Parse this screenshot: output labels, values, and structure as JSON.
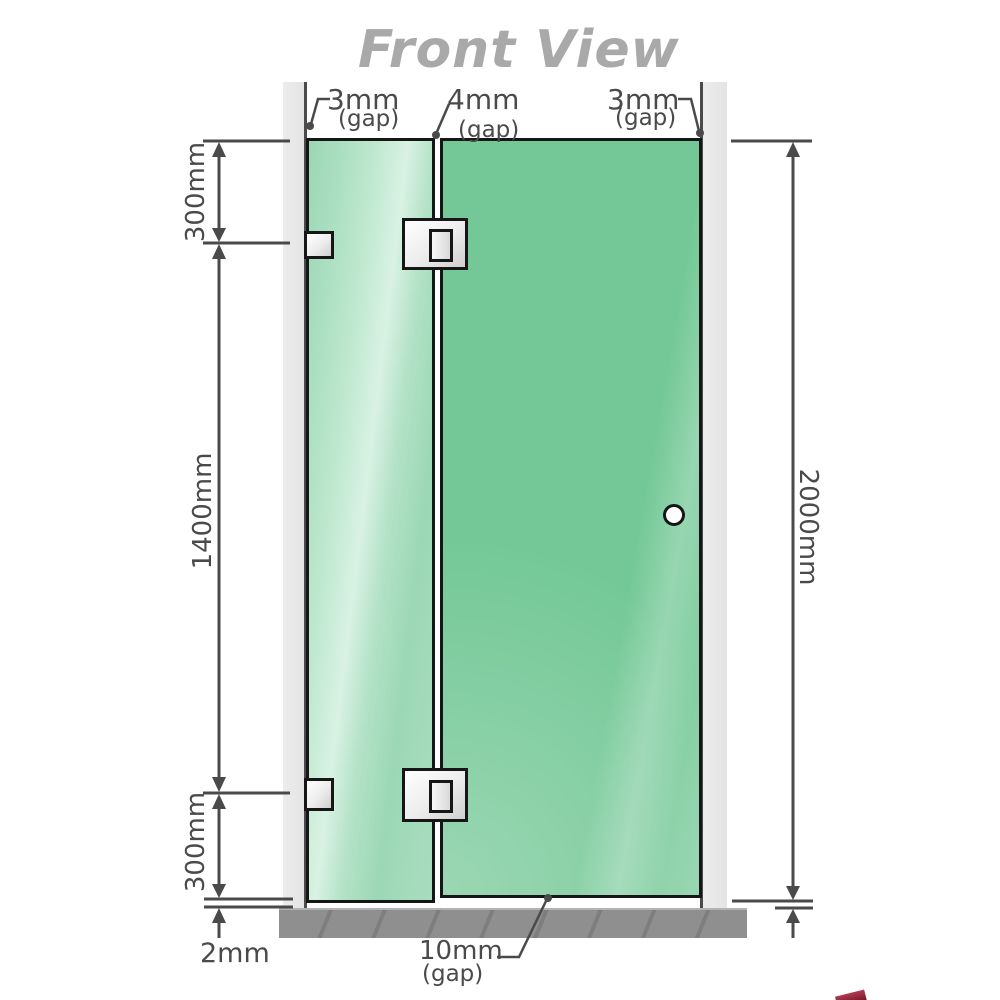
{
  "title": "Front View",
  "gaps": {
    "top_left": {
      "value": "3mm",
      "label": "(gap)"
    },
    "top_center": {
      "value": "4mm",
      "label": "(gap)"
    },
    "top_right": {
      "value": "3mm",
      "label": "(gap)"
    },
    "bottom_center": {
      "value": "10mm",
      "label": "(gap)"
    }
  },
  "dimensions": {
    "left_top": "300mm",
    "left_middle": "1400mm",
    "left_bottom": "300mm",
    "right_total": "2000mm",
    "floor_clearance": "2mm"
  },
  "colors": {
    "title_gray": "#a9a9a9",
    "dimension_gray": "#4a4a4a",
    "glass_door_green": "#74c897",
    "glass_fixed_green": "#a9dec0",
    "wall_channel_gray": "#e8e8e8",
    "floor_gray": "#8f8f8f",
    "fitting_outline": "#161616",
    "logo_red": "#8d2038"
  }
}
